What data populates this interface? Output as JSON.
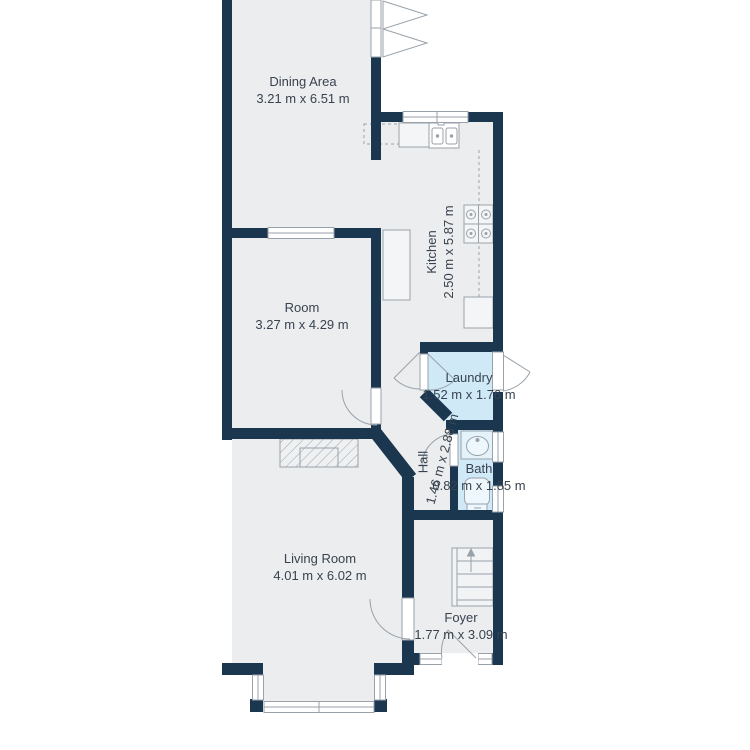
{
  "title": "Floor plan",
  "colors": {
    "wall": "#1b3750",
    "floor": "#ebedee",
    "wet_room_floor": "#cfe9f7",
    "fixture_line": "#98a2ab",
    "label_text": "#394350",
    "background": "#ffffff"
  },
  "rooms": [
    {
      "id": "dining",
      "name": "Dining Area",
      "dims": "3.21 m x 6.51 m"
    },
    {
      "id": "kitchen",
      "name": "Kitchen",
      "dims": "2.50 m x 5.87 m"
    },
    {
      "id": "room",
      "name": "Room",
      "dims": "3.27 m x 4.29 m"
    },
    {
      "id": "laundry",
      "name": "Laundry",
      "dims": "1.52 m x 1.76 m"
    },
    {
      "id": "hall",
      "name": "Hall",
      "dims": "1.46 m x 2.88 m"
    },
    {
      "id": "bath",
      "name": "Bath",
      "dims": "0.82 m x 1.85 m"
    },
    {
      "id": "living",
      "name": "Living Room",
      "dims": "4.01 m x 6.02 m"
    },
    {
      "id": "foyer",
      "name": "Foyer",
      "dims": "1.77 m x 3.09 m"
    }
  ],
  "icons": [
    "kitchen-sink-icon",
    "stove-icon",
    "bath-sink-icon",
    "toilet-icon",
    "stairs-icon",
    "fireplace-icon",
    "door-swing-icon",
    "window-icon"
  ]
}
